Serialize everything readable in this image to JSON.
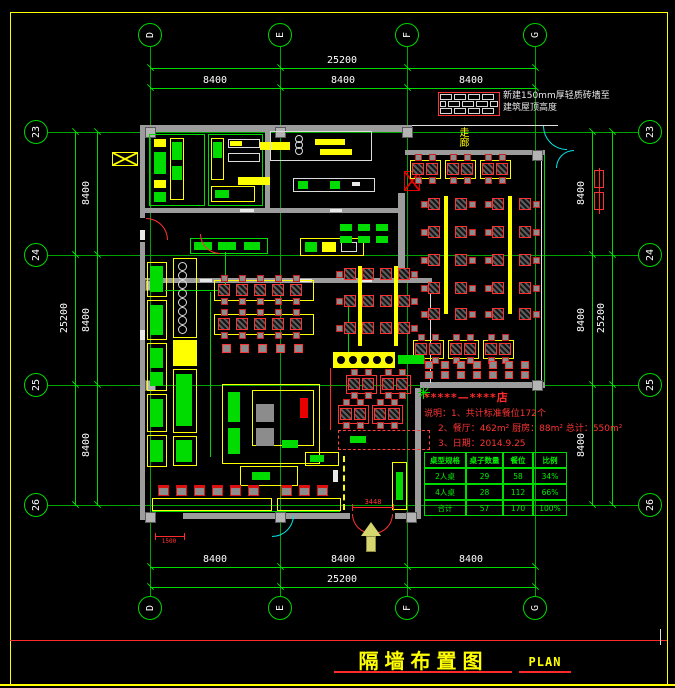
{
  "page": {
    "title": "隔墙布置图",
    "plan_label": "PLAN"
  },
  "grid": {
    "col_axes": [
      "D",
      "E",
      "F",
      "G"
    ],
    "row_axes": [
      "23",
      "24",
      "25",
      "26"
    ]
  },
  "dims": {
    "top_total": "25200",
    "top_bays": [
      "8400",
      "8400",
      "8400"
    ],
    "bottom_total": "25200",
    "bottom_bays": [
      "8400",
      "8400",
      "8400"
    ],
    "left_total": "25200",
    "left_bays": [
      "8400",
      "8400",
      "8400"
    ],
    "right_total": "25200",
    "right_bays": [
      "8400",
      "8400",
      "8400"
    ],
    "entrance": "3448",
    "side_door": "1500"
  },
  "legend": {
    "note_line1": "新建150mm厚轻质砖墙至",
    "note_line2": "建筑屋顶高度"
  },
  "labels": {
    "corridor": "走廊"
  },
  "notes": {
    "shop": "*****—****店",
    "line1": "说明：1、共计标准餐位172个",
    "line2": "2、餐厅：462m²  厨房：88m²  总计：550m²",
    "line3": "3、日期：2014.9.25"
  },
  "stats": {
    "headers": [
      "桌型规格",
      "桌子数量",
      "餐位",
      "比例"
    ],
    "rows": [
      [
        "2人桌",
        "29",
        "58",
        "34%"
      ],
      [
        "4人桌",
        "28",
        "112",
        "66%"
      ],
      [
        "合计",
        "57",
        "170",
        "100%"
      ]
    ]
  },
  "colors": {
    "grid_green": "#00d800",
    "wall_gray": "#9c9c9c",
    "accent_red": "#ff2a2a",
    "accent_yellow": "#ffff00",
    "cyan": "#00e6e6"
  }
}
